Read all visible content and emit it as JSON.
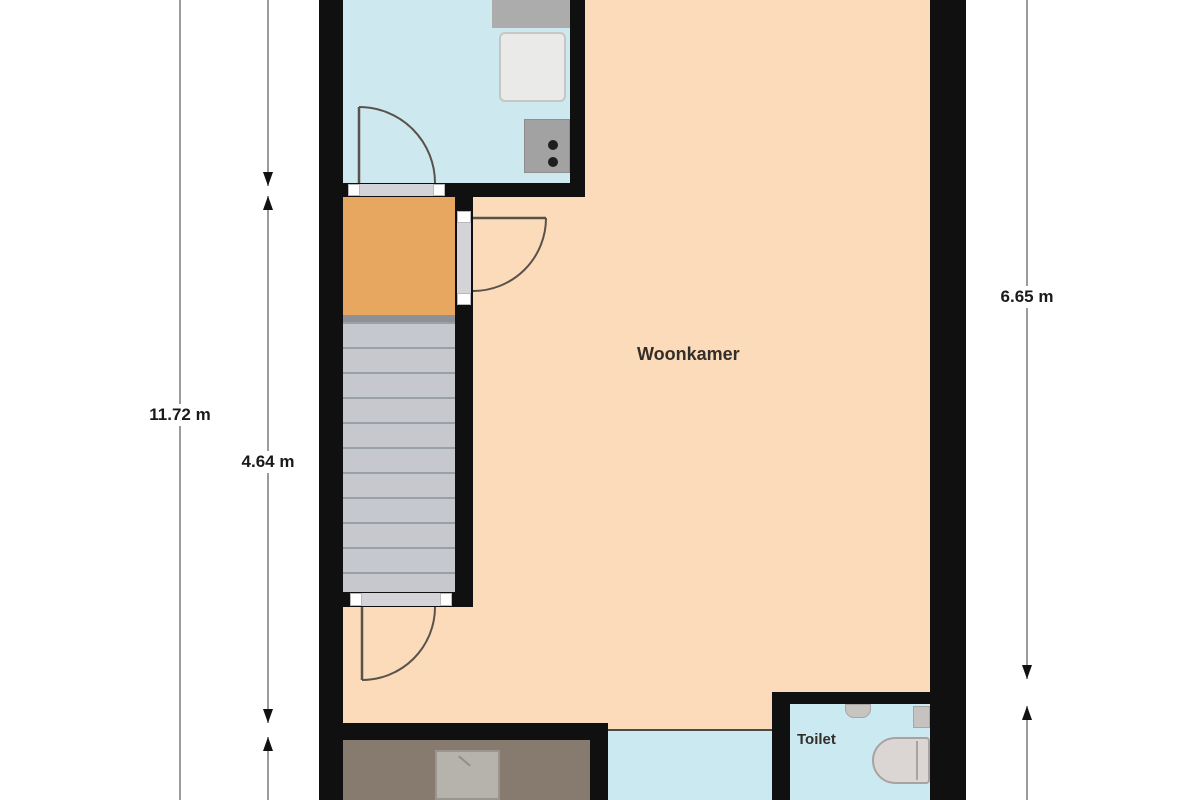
{
  "type": "floor-plan",
  "labels": {
    "woonkamer": "Woonkamer",
    "toilet": "Toilet"
  },
  "dimensions": {
    "overall": "11.72 m",
    "hall_stairs": "4.64 m",
    "living": "6.65 m"
  },
  "colors": {
    "wall": "#101010",
    "living-floor": "#FBDBB9",
    "kitchen-floor": "#CDE8EF",
    "hall-floor": "#E7A760",
    "stairs-base": "#C6C8CD",
    "stairs-tread": "#9AA0A8",
    "utility-floor": "#867B6E",
    "wet-hall-floor": "#CBE9F1",
    "toilet-floor": "#CBE9F1",
    "fixture-gray": "#DBD6D4",
    "dimension-line": "#7A7A7A",
    "text": "#1A1A1A",
    "background": "#FFFFFF"
  }
}
